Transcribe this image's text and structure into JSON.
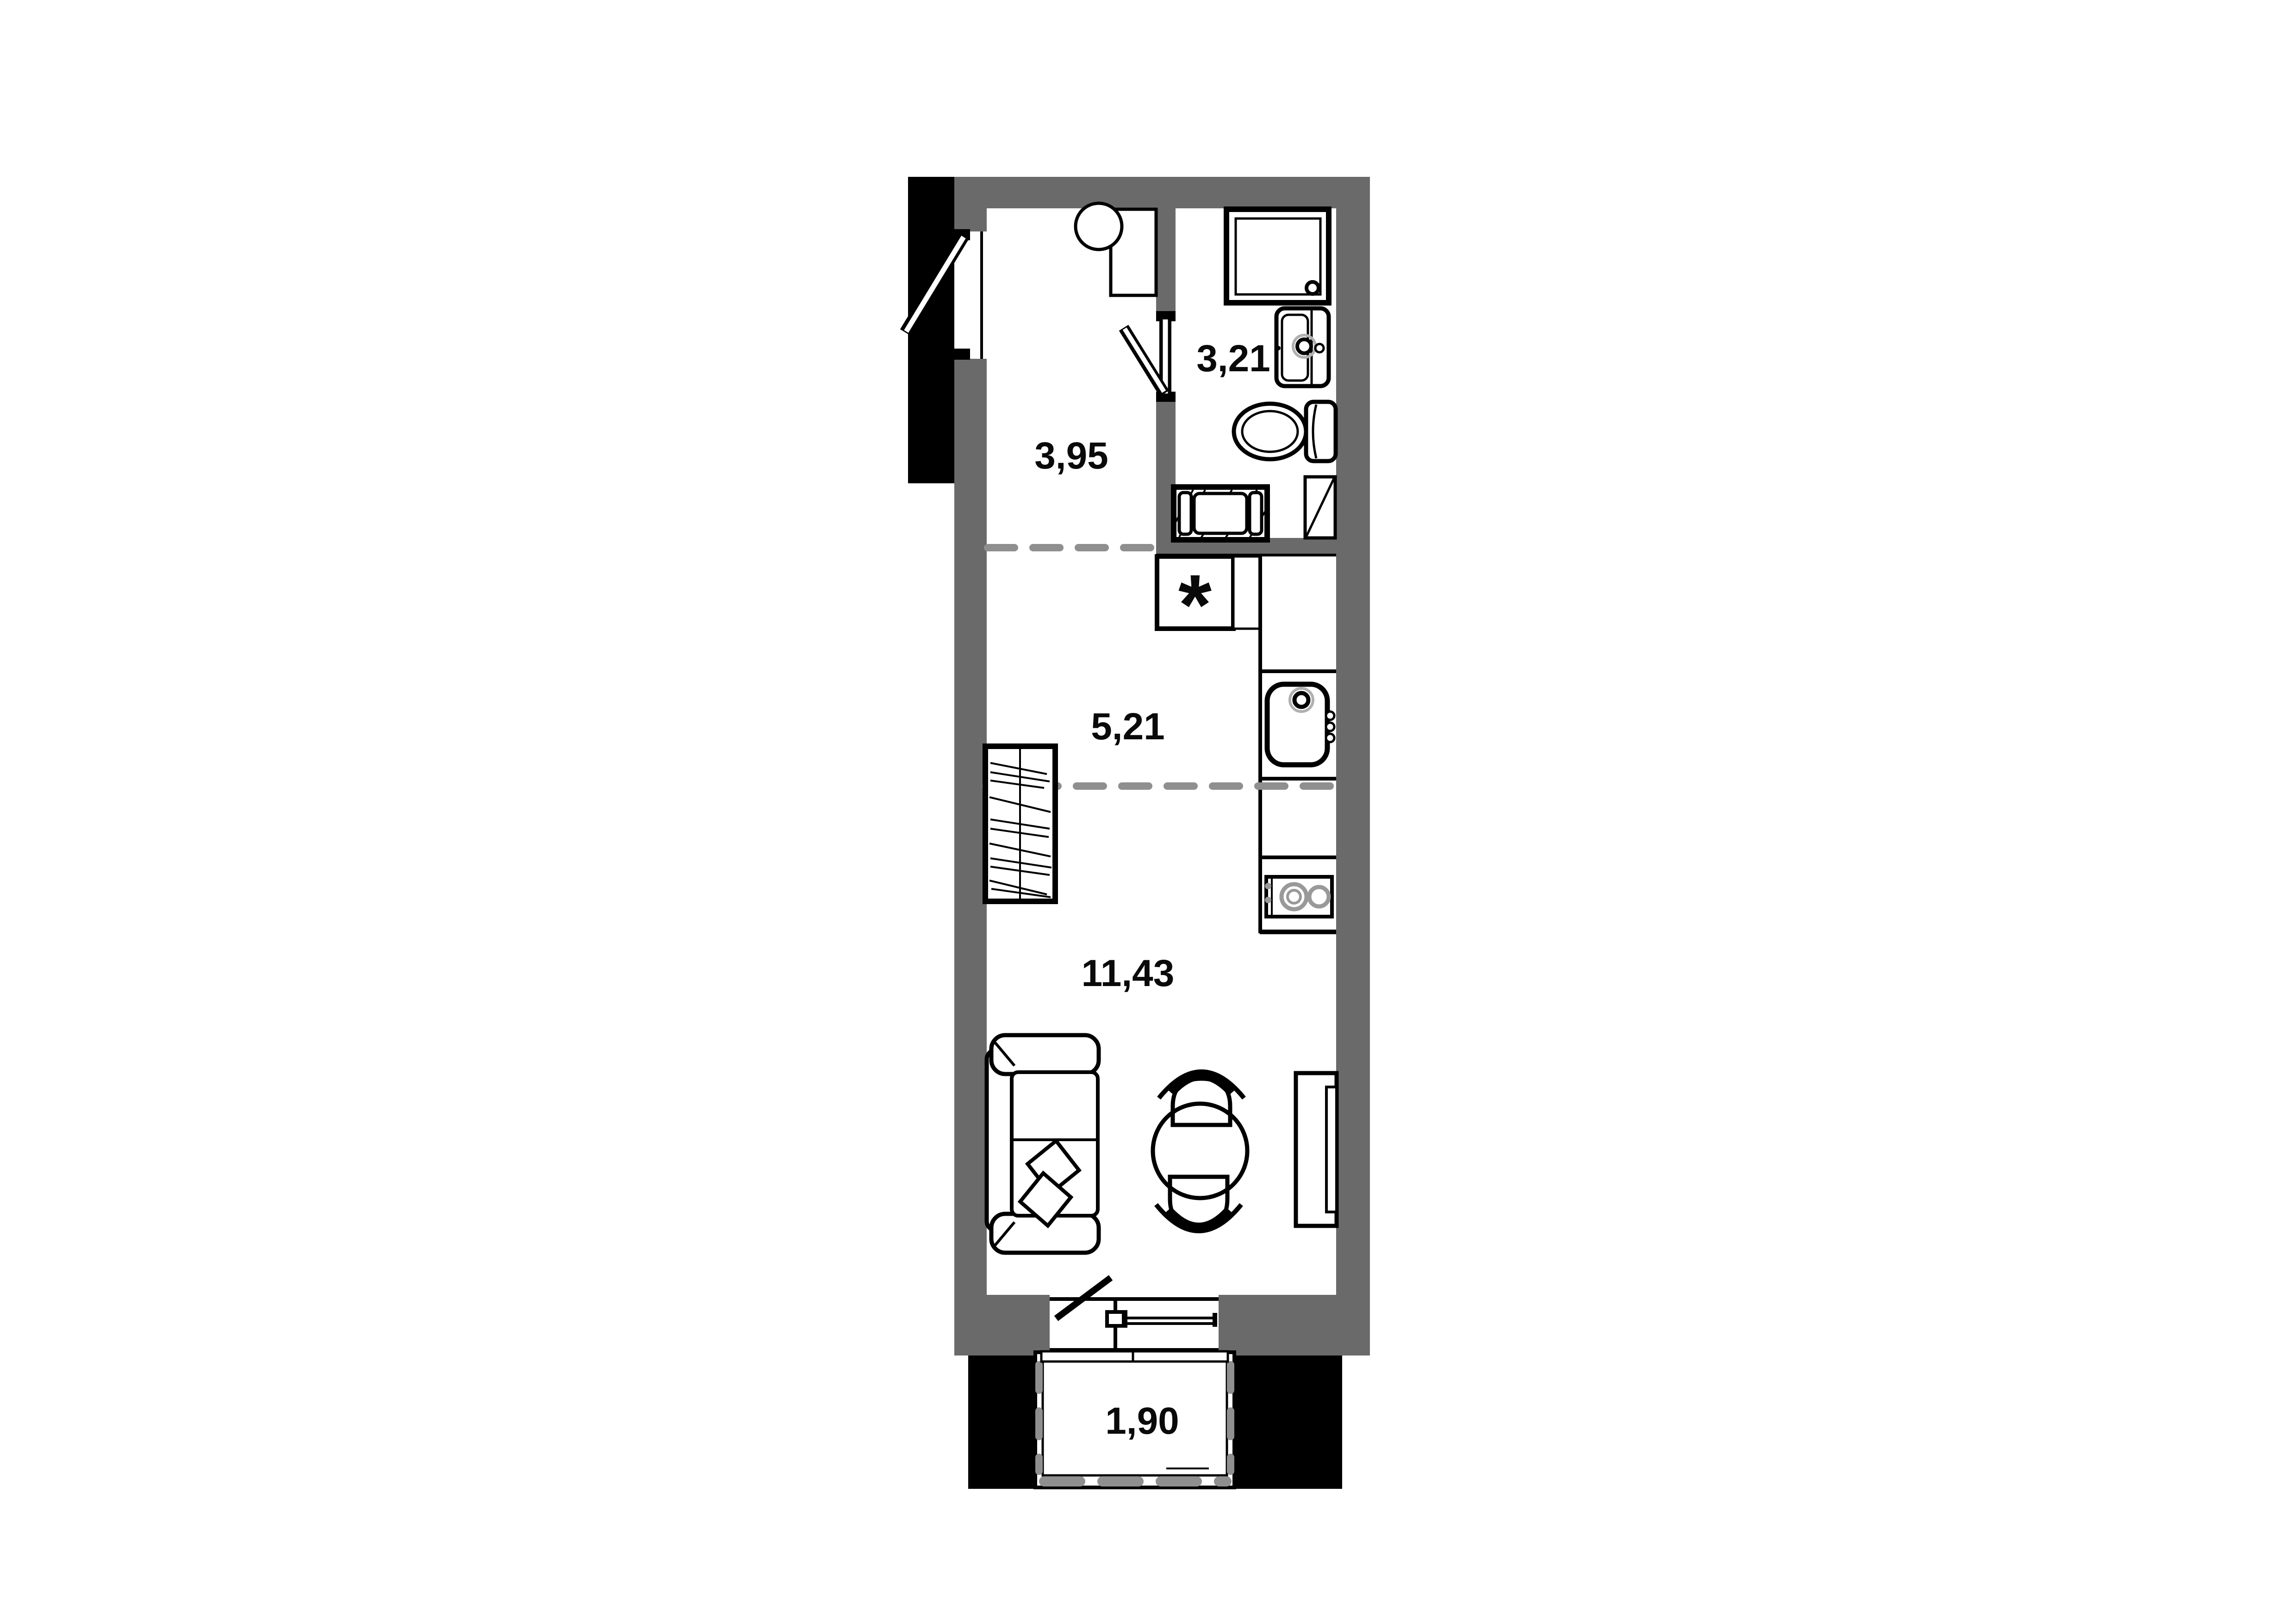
{
  "plan": {
    "type": "apartment-floor-plan",
    "units": "m²",
    "rooms": {
      "hallway": {
        "name": "hallway",
        "area": "3,95"
      },
      "bathroom": {
        "name": "bathroom",
        "area": "3,21"
      },
      "kitchen": {
        "name": "kitchen",
        "area": "5,21"
      },
      "living": {
        "name": "living-room",
        "area": "11,43"
      },
      "balcony": {
        "name": "balcony",
        "area": "1,90"
      }
    },
    "kitchen_marker": "*",
    "colors": {
      "wall": "#6a6a6a",
      "outline": "#000000",
      "zone_dash": "#8f8f8f",
      "fixture_gray": "#999999",
      "faucet_halo": "#b0b0b0",
      "background": "#ffffff",
      "exterior_mass": "#000000"
    }
  }
}
